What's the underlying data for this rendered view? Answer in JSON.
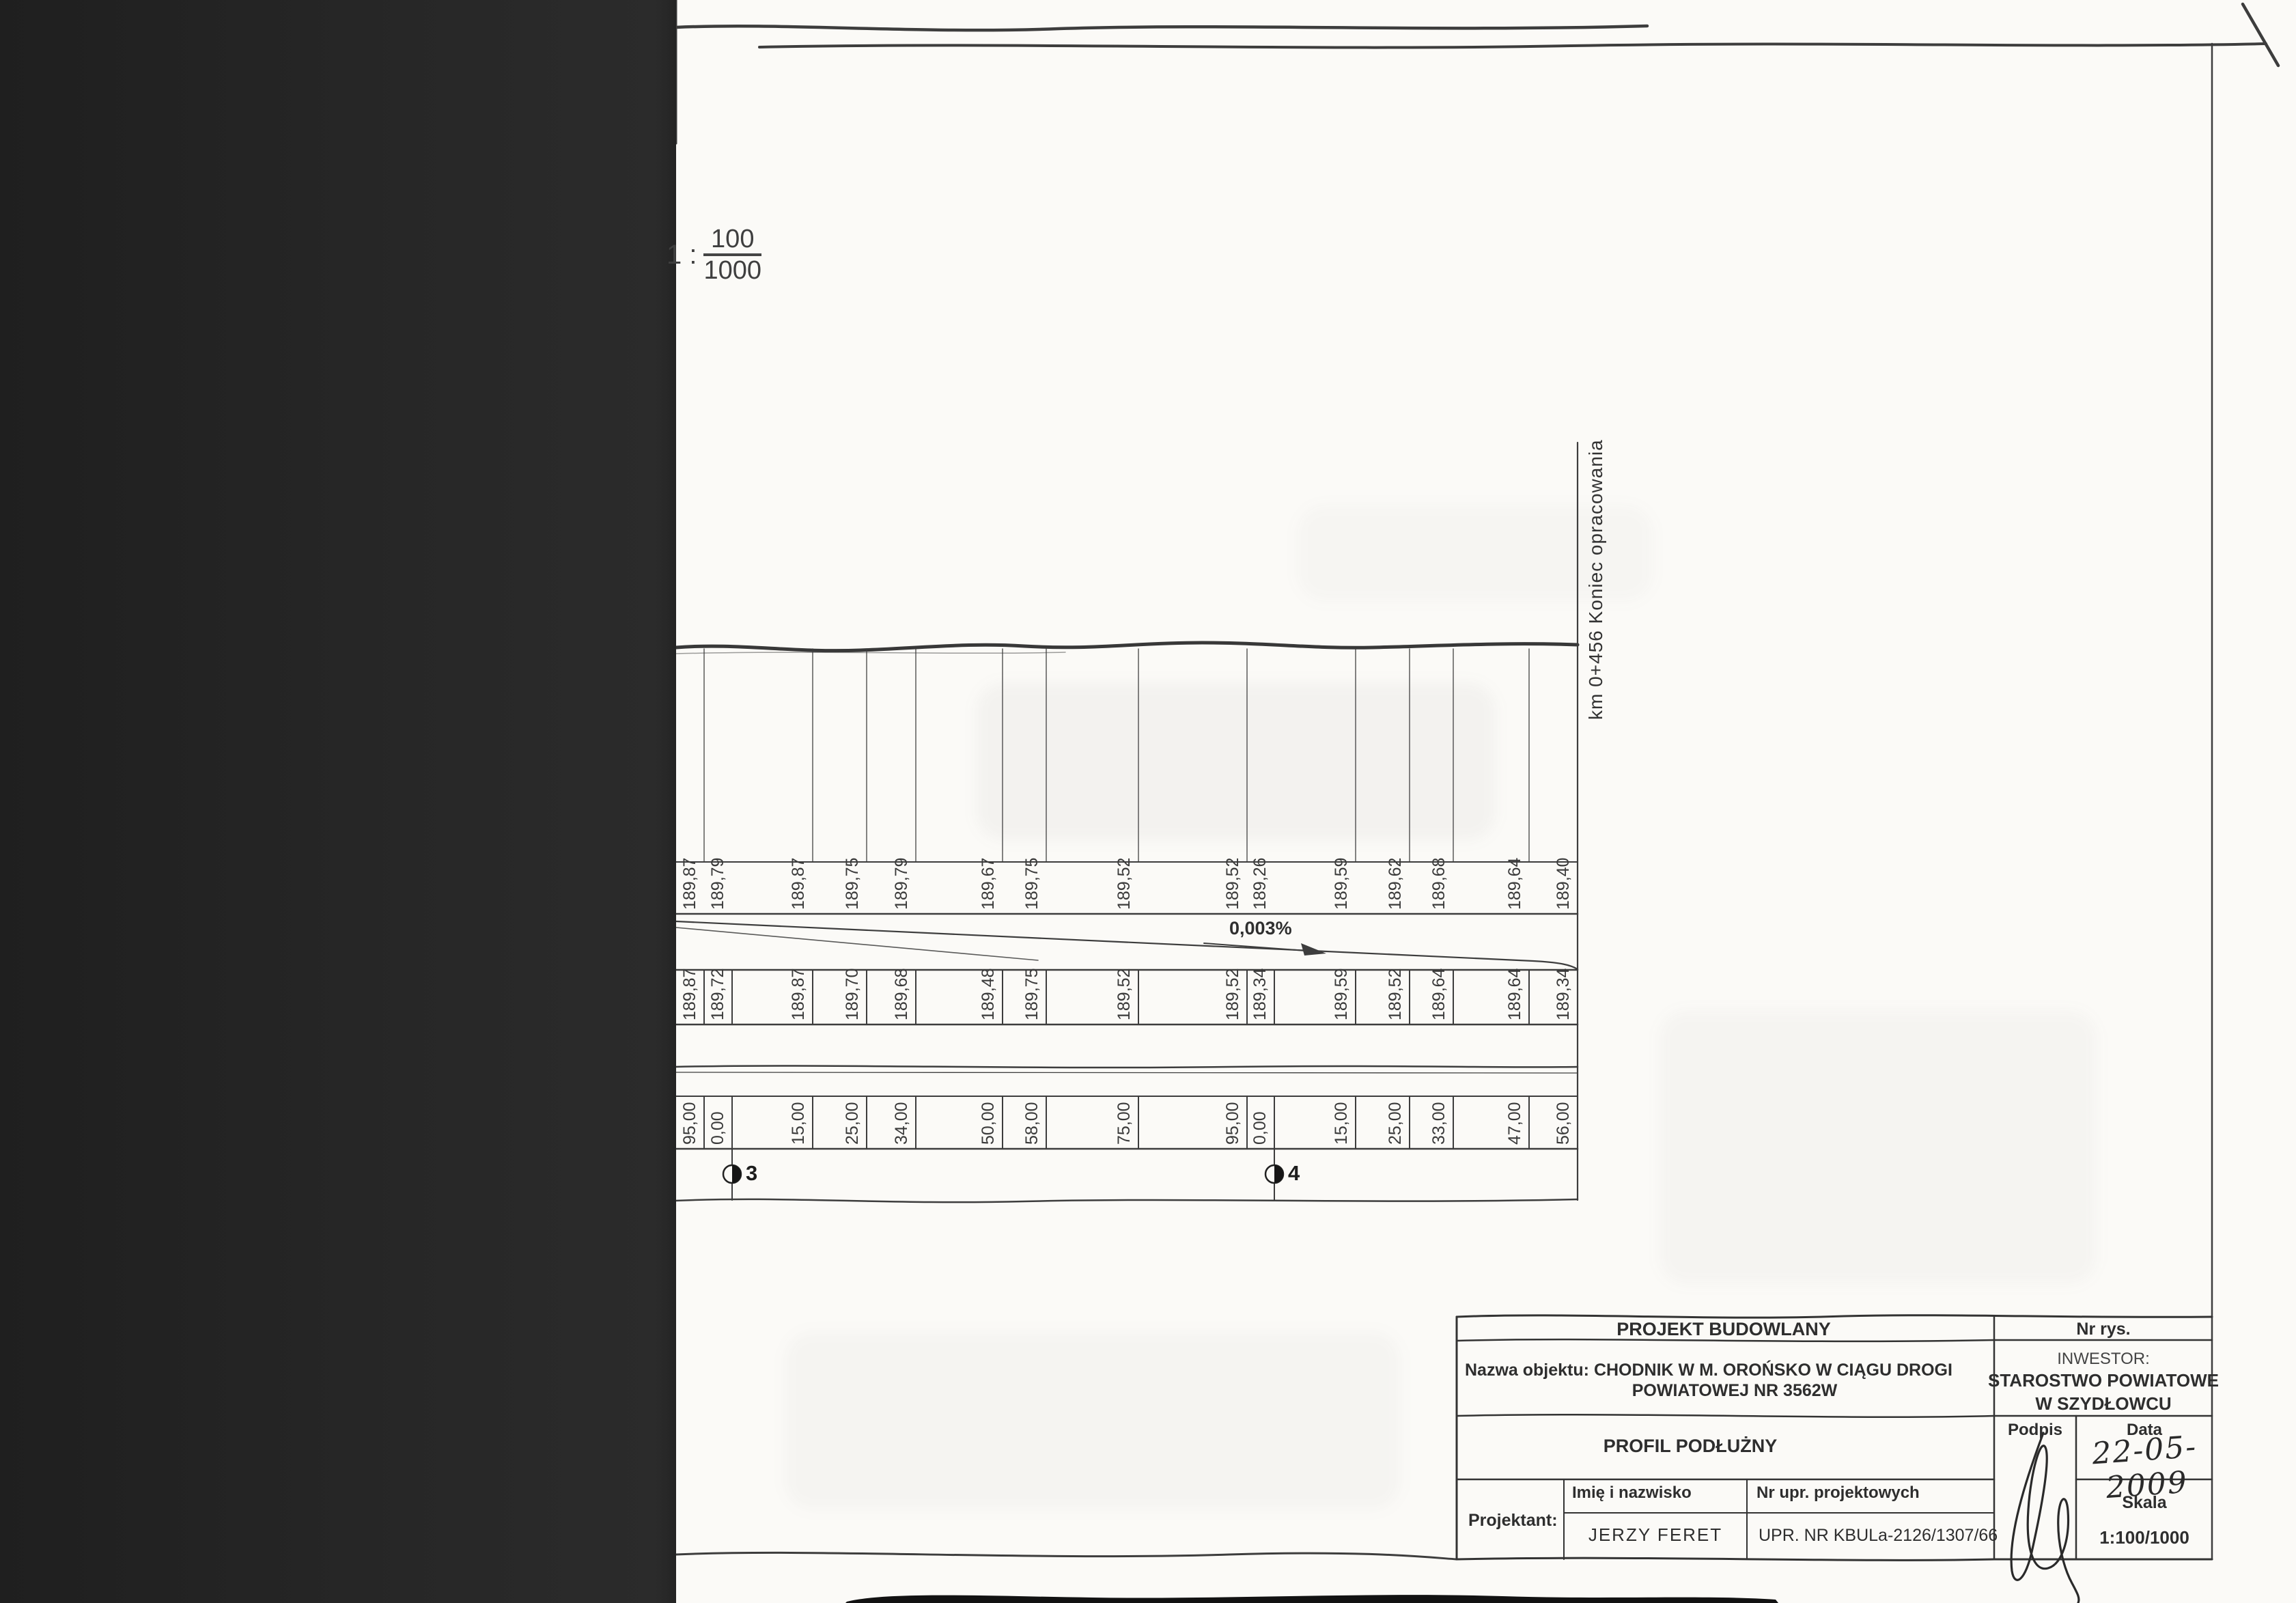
{
  "drawing": {
    "scale_note": {
      "prefix": "1 :",
      "numerator": "100",
      "denominator": "1000"
    },
    "slope_label": "0,003%",
    "end_marker_label": "km 0+456  Koniec opracowania",
    "hectometer_markers": [
      {
        "label": "3"
      },
      {
        "label": "4"
      }
    ],
    "profile_rows": {
      "elevations_top": [
        "189,87",
        "189,79",
        "189,87",
        "189,75",
        "189,79",
        "189,67",
        "189,75",
        "189,52",
        "189,52",
        "189,26",
        "189,59",
        "189,62",
        "189,68",
        "189,64",
        "189,40"
      ],
      "elevations_bottom": [
        "189,87",
        "189,72",
        "189,87",
        "189,70",
        "189,68",
        "189,48",
        "189,75",
        "189,52",
        "189,52",
        "189,34",
        "189,59",
        "189,52",
        "189,64",
        "189,64",
        "189,34"
      ],
      "distances": [
        "95,00",
        "0,00",
        "15,00",
        "25,00",
        "34,00",
        "50,00",
        "58,00",
        "75,00",
        "95,00",
        "0,00",
        "15,00",
        "25,00",
        "33,00",
        "47,00",
        "56,00"
      ]
    }
  },
  "title_block": {
    "project_type": "PROJEKT BUDOWLANY",
    "drawing_number_label": "Nr rys.",
    "object_name_prefix": "Nazwa objektu:",
    "object_name_line1": "CHODNIK W M. OROŃSKO  W CIĄGU DROGI",
    "object_name_line2": "POWIATOWEJ  NR  3562W",
    "investor_label": "INWESTOR:",
    "investor_line1": "STAROSTWO  POWIATOWE",
    "investor_line2": "W  SZYDŁOWCU",
    "drawing_title": "PROFIL  PODŁUŻNY",
    "signature_label": "Podpis",
    "date_label": "Data",
    "date_value": "22-05-2009",
    "designer_label": "Projektant:",
    "name_header": "Imię i nazwisko",
    "license_header": "Nr upr. projektowych",
    "designer_name": "JERZY  FERET",
    "license_number": "UPR.  NR  KBULa-2126/1307/66",
    "scale_label": "Skala",
    "scale_value": "1:100/1000"
  }
}
